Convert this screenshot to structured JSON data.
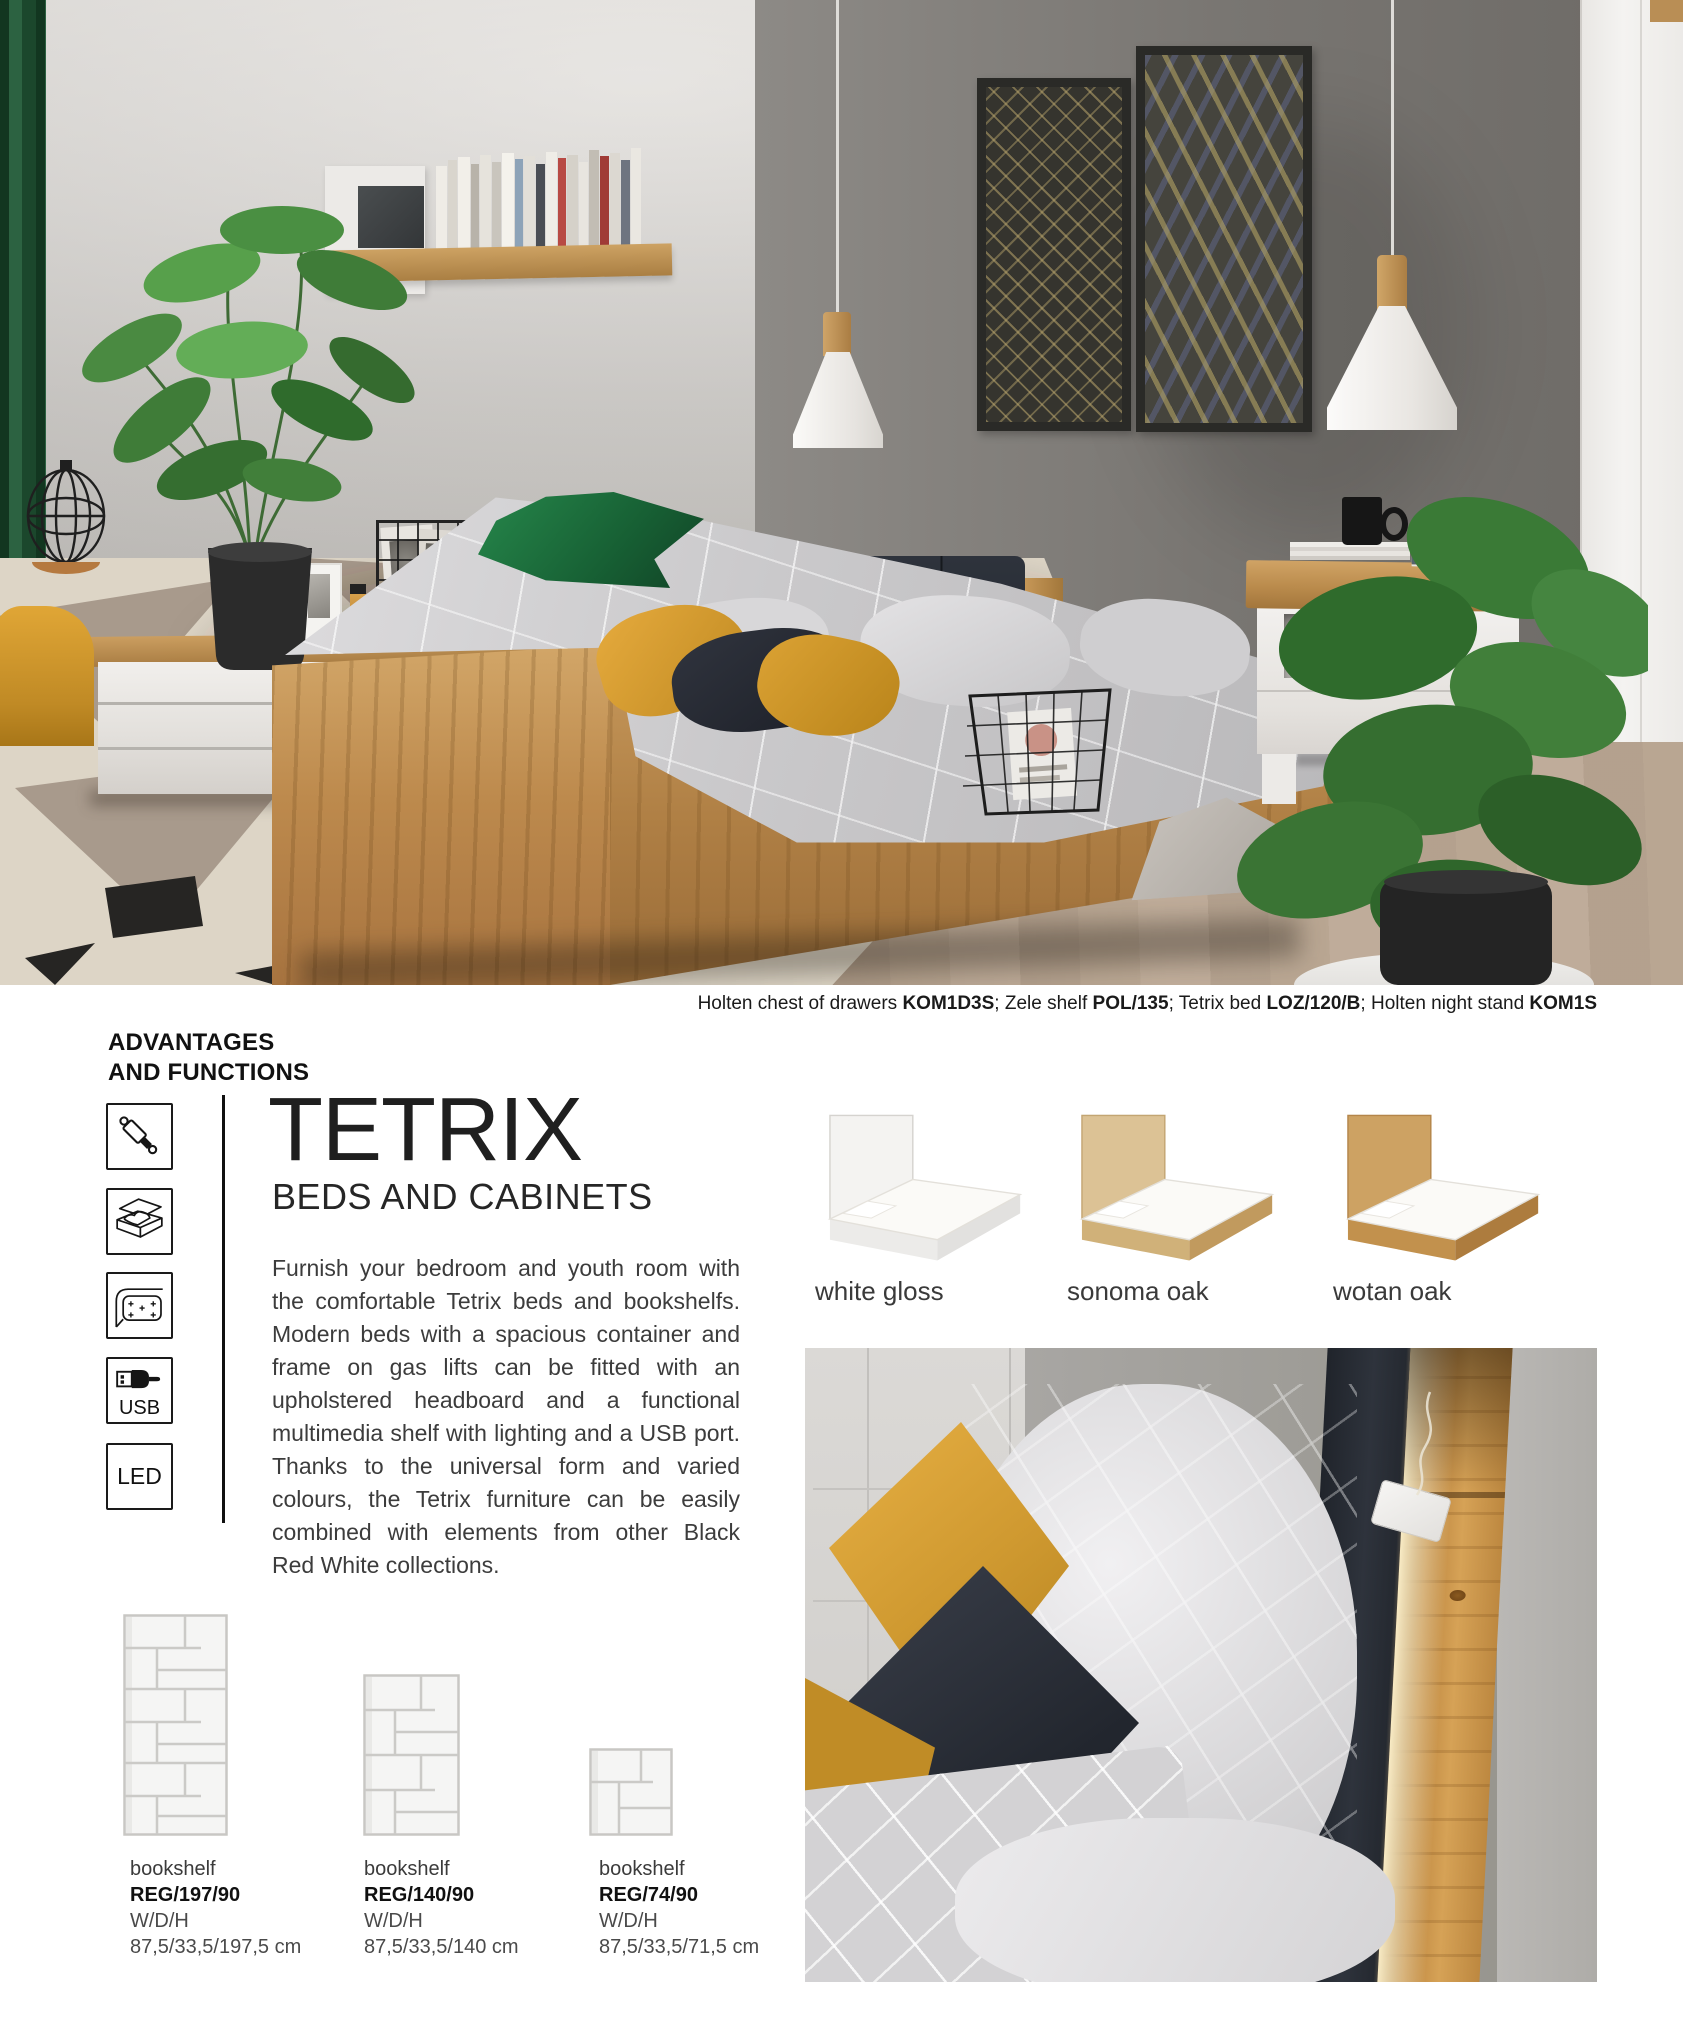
{
  "caption": {
    "segments": [
      {
        "text": "Holten chest of drawers ",
        "bold": false
      },
      {
        "text": "KOM1D3S",
        "bold": true
      },
      {
        "text": "; Zele shelf ",
        "bold": false
      },
      {
        "text": "POL/135",
        "bold": true
      },
      {
        "text": "; Tetrix bed ",
        "bold": false
      },
      {
        "text": "LOZ/120/B",
        "bold": true
      },
      {
        "text": "; Holten night stand ",
        "bold": false
      },
      {
        "text": "KOM1S",
        "bold": true
      }
    ]
  },
  "advantages": {
    "line1": "ADVANTAGES",
    "line2": "AND FUNCTIONS",
    "icons": [
      {
        "name": "gas-lift-icon"
      },
      {
        "name": "storage-container-icon"
      },
      {
        "name": "upholstered-headboard-icon"
      },
      {
        "name": "usb-icon",
        "label": "USB"
      },
      {
        "name": "led-icon",
        "label": "LED"
      }
    ]
  },
  "intro": {
    "title": "TETRIX",
    "subtitle": "BEDS AND CABINETS",
    "body": "Furnish your bedroom and youth room with the comfortable Tetrix beds and bookshelfs. Modern beds with a spacious container and frame on gas lifts can be fitted with an upholstered headboard and a functional multimedia shelf with lighting and a USB port. Thanks to the universal form and varied colours, the Tetrix furniture can be easily combined with elements from other Black Red White collections."
  },
  "variants": [
    {
      "label": "white gloss"
    },
    {
      "label": "sonoma oak"
    },
    {
      "label": "wotan oak"
    }
  ],
  "bookshelves": [
    {
      "type": "bookshelf",
      "code": "REG/197/90",
      "dims_label": "W/D/H",
      "dims": "87,5/33,5/197,5 cm"
    },
    {
      "type": "bookshelf",
      "code": "REG/140/90",
      "dims_label": "W/D/H",
      "dims": "87,5/33,5/140 cm"
    },
    {
      "type": "bookshelf",
      "code": "REG/74/90",
      "dims_label": "W/D/H",
      "dims": "87,5/33,5/71,5 cm"
    }
  ],
  "colors": {
    "accent_wood": "#c08a45",
    "headboard_navy": "#262b33",
    "pillow_mustard": "#d79a2e",
    "curtain_green": "#1d4a30",
    "wall_dark_gray": "#797672",
    "text_dark": "#1a1a1a",
    "text_body": "#3c3c3c"
  }
}
